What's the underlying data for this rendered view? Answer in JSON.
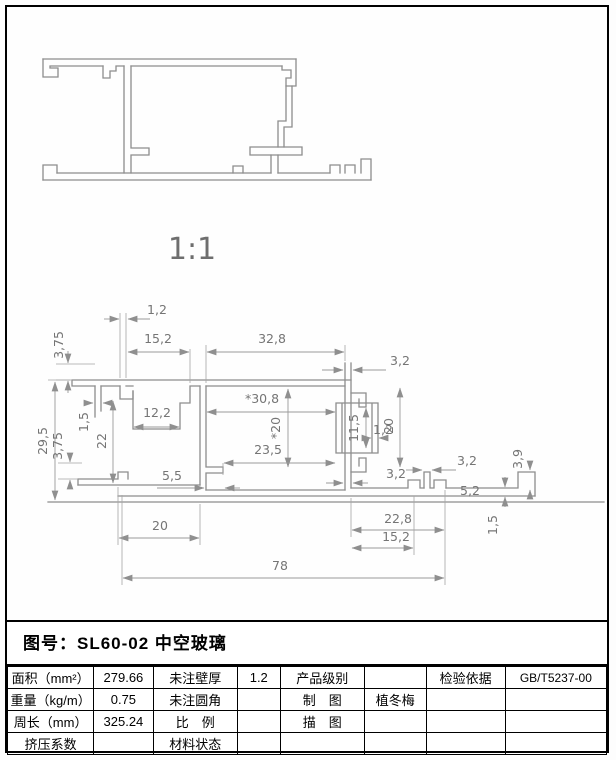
{
  "top_view": {
    "scale_label": "1:1"
  },
  "dim_labels": [
    "1,2",
    "3,75",
    "15,2",
    "32,8",
    "3,2",
    "29,5",
    "1,5",
    "22",
    "3,75",
    "12,2",
    "*30,8",
    "*20",
    "23,5",
    "5,5",
    "11,5",
    "1,2",
    "20",
    "3,2",
    "3,2",
    "3,9",
    "5,2",
    "1,5",
    "22,8",
    "15,2",
    "20",
    "78"
  ],
  "title_block": {
    "title": "图号：SL60-02 中空玻璃"
  },
  "spec_table": {
    "rows": [
      [
        "面积（mm²）",
        "279.66",
        "未注壁厚",
        "1.2",
        "产品级别",
        "",
        "检验依据",
        "GB/T5237-00"
      ],
      [
        "重量（kg/m）",
        "0.75",
        "未注圆角",
        "",
        "制　图",
        "植冬梅",
        "",
        ""
      ],
      [
        "周长（mm）",
        "325.24",
        "比　例",
        "",
        "描　图",
        "",
        "",
        ""
      ],
      [
        "挤压系数",
        "",
        "材料状态",
        "",
        "",
        "",
        "",
        ""
      ]
    ]
  }
}
